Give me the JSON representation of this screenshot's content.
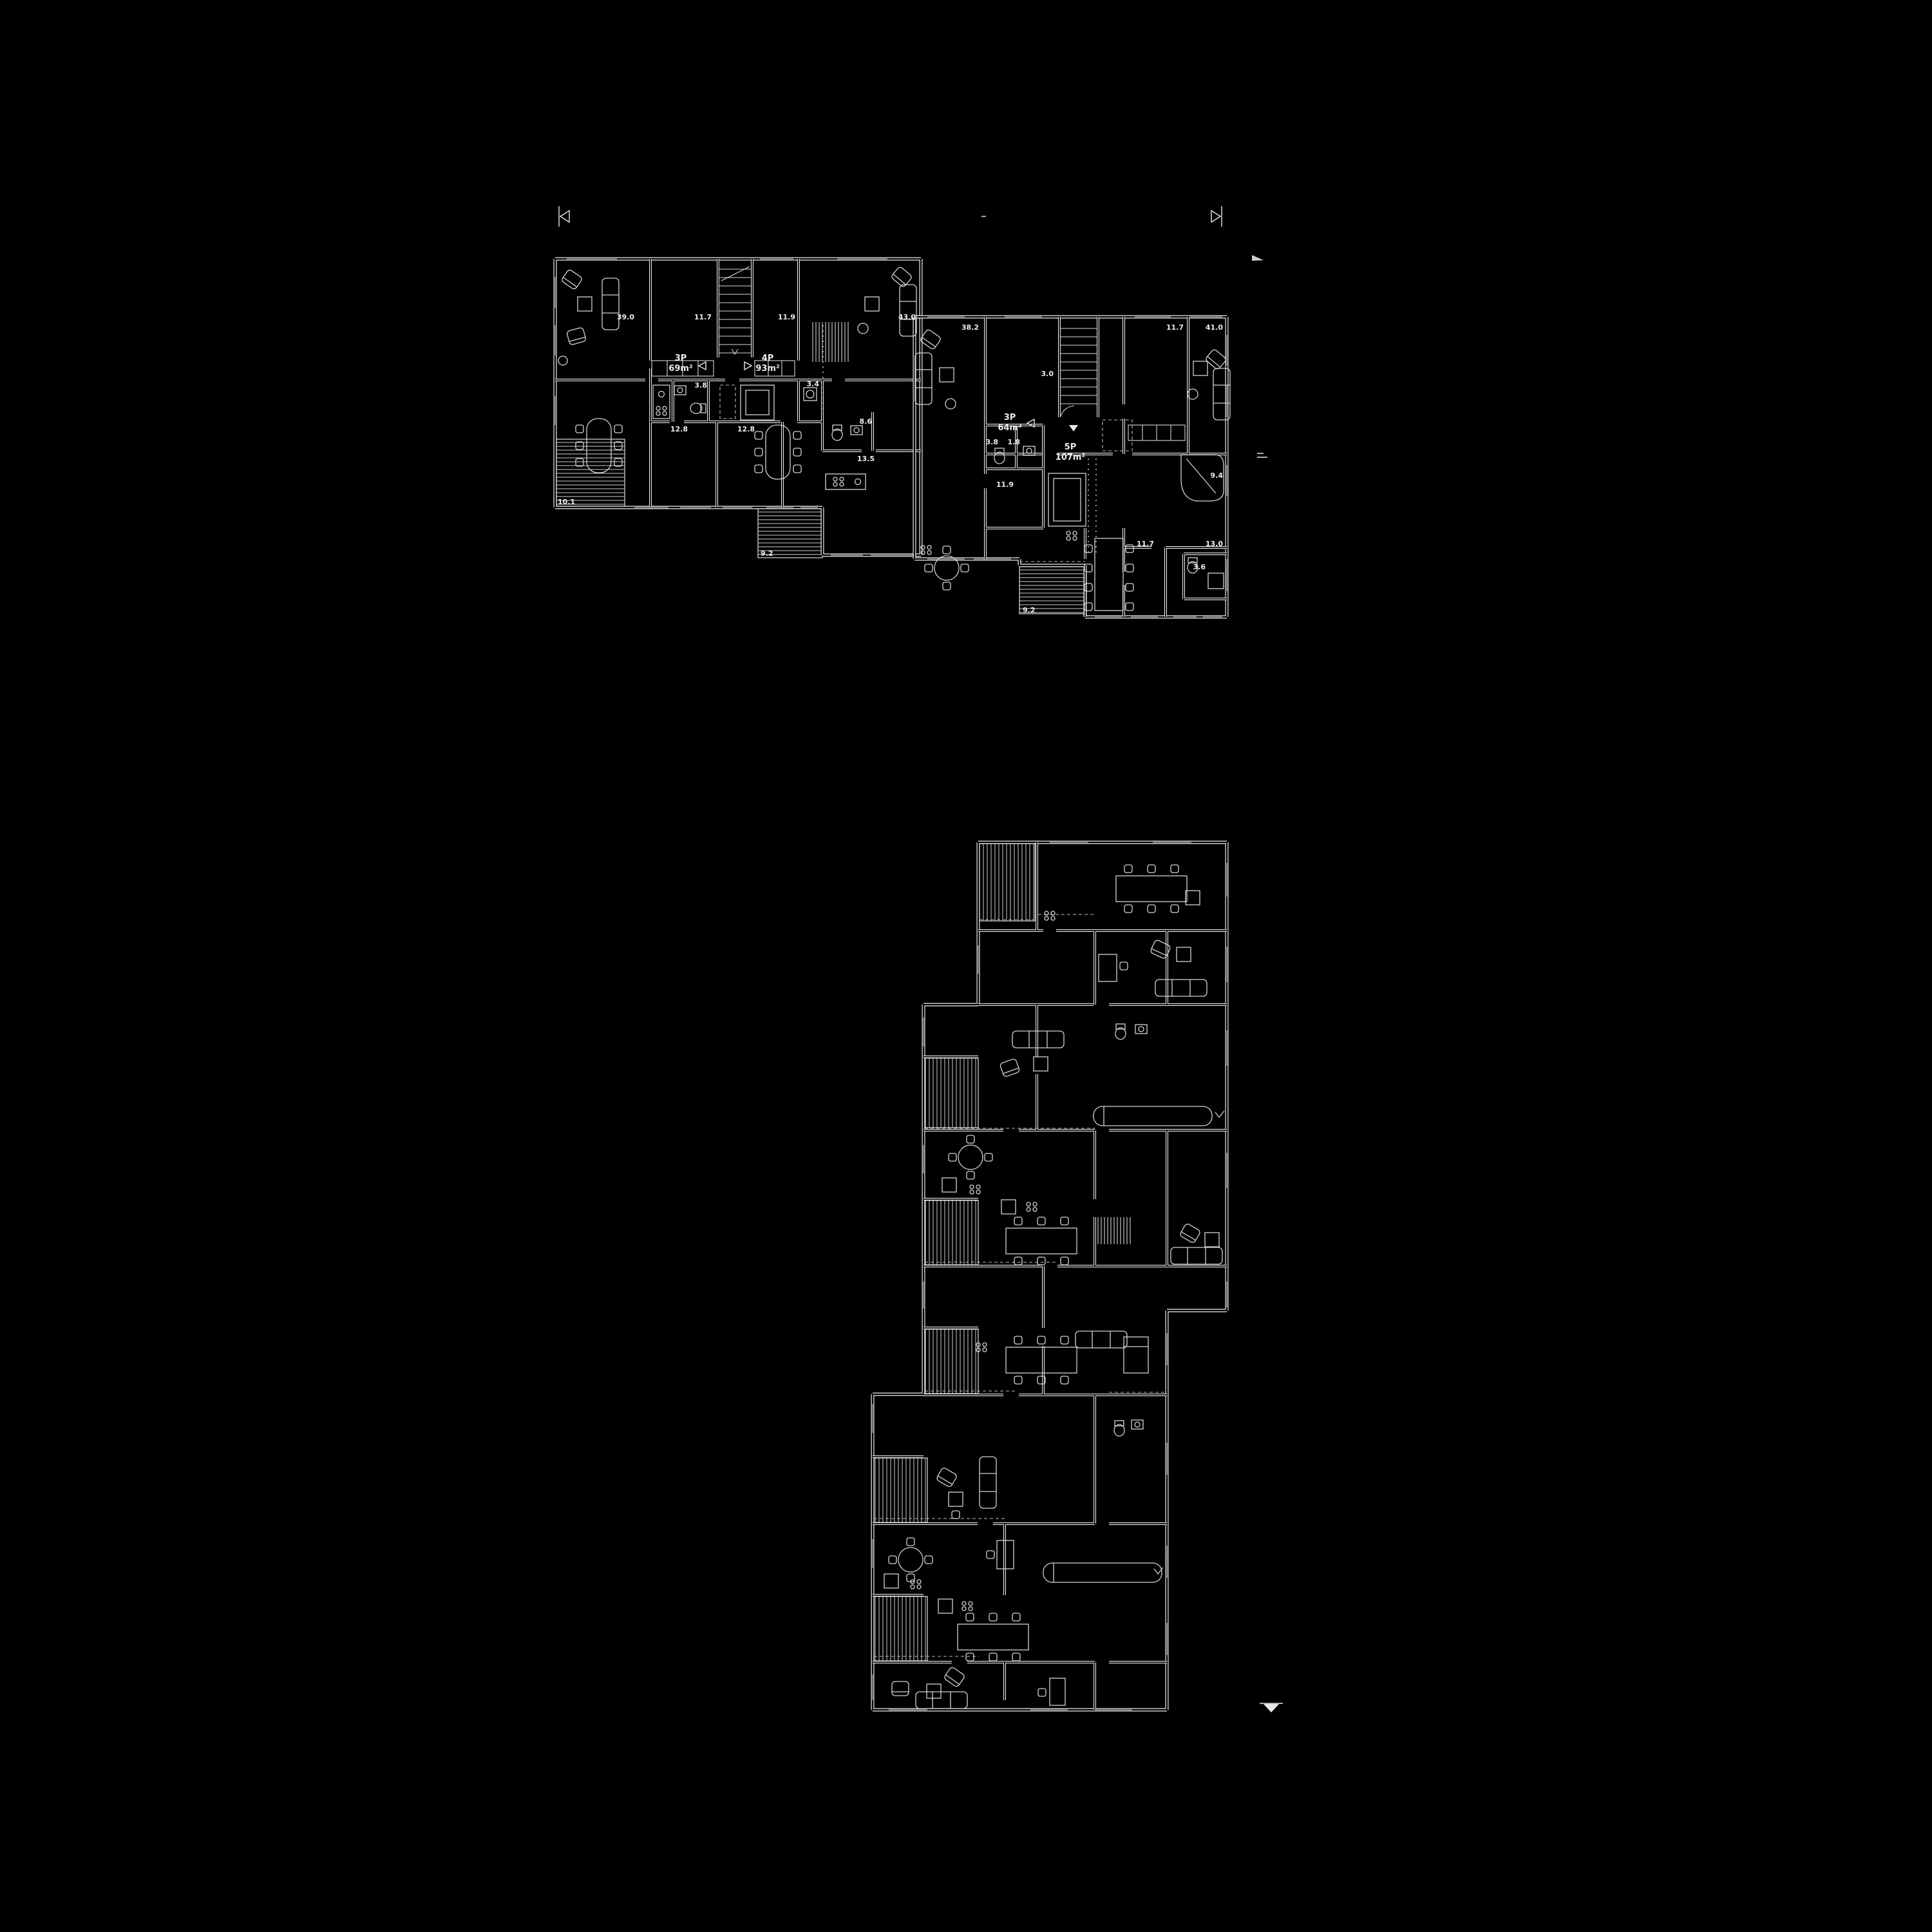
{
  "page": {
    "background_color": "#000000",
    "line_color": "#f2f2f2"
  },
  "top_plan": {
    "units": [
      {
        "persons": "3P",
        "area": "69m²"
      },
      {
        "persons": "4P",
        "area": "93m²"
      },
      {
        "persons": "3P",
        "area": "64m²"
      },
      {
        "persons": "5P",
        "area": "107m²"
      }
    ],
    "room_areas_left": [
      "39.0",
      "11.7",
      "11.9",
      "43.0",
      "3.8",
      "3.4",
      "12.8",
      "12.8",
      "8.6",
      "13.5"
    ],
    "terrace_areas_left": [
      "10.1",
      "9.2"
    ],
    "room_areas_right": [
      "38.2",
      "11.7",
      "41.0",
      "3.0",
      "3.8",
      "1.8",
      "11.9",
      "9.4",
      "11.7",
      "13.0",
      "3.6"
    ],
    "terrace_areas_right": [
      "9.2"
    ]
  },
  "bottom_plan": {
    "labels": []
  }
}
